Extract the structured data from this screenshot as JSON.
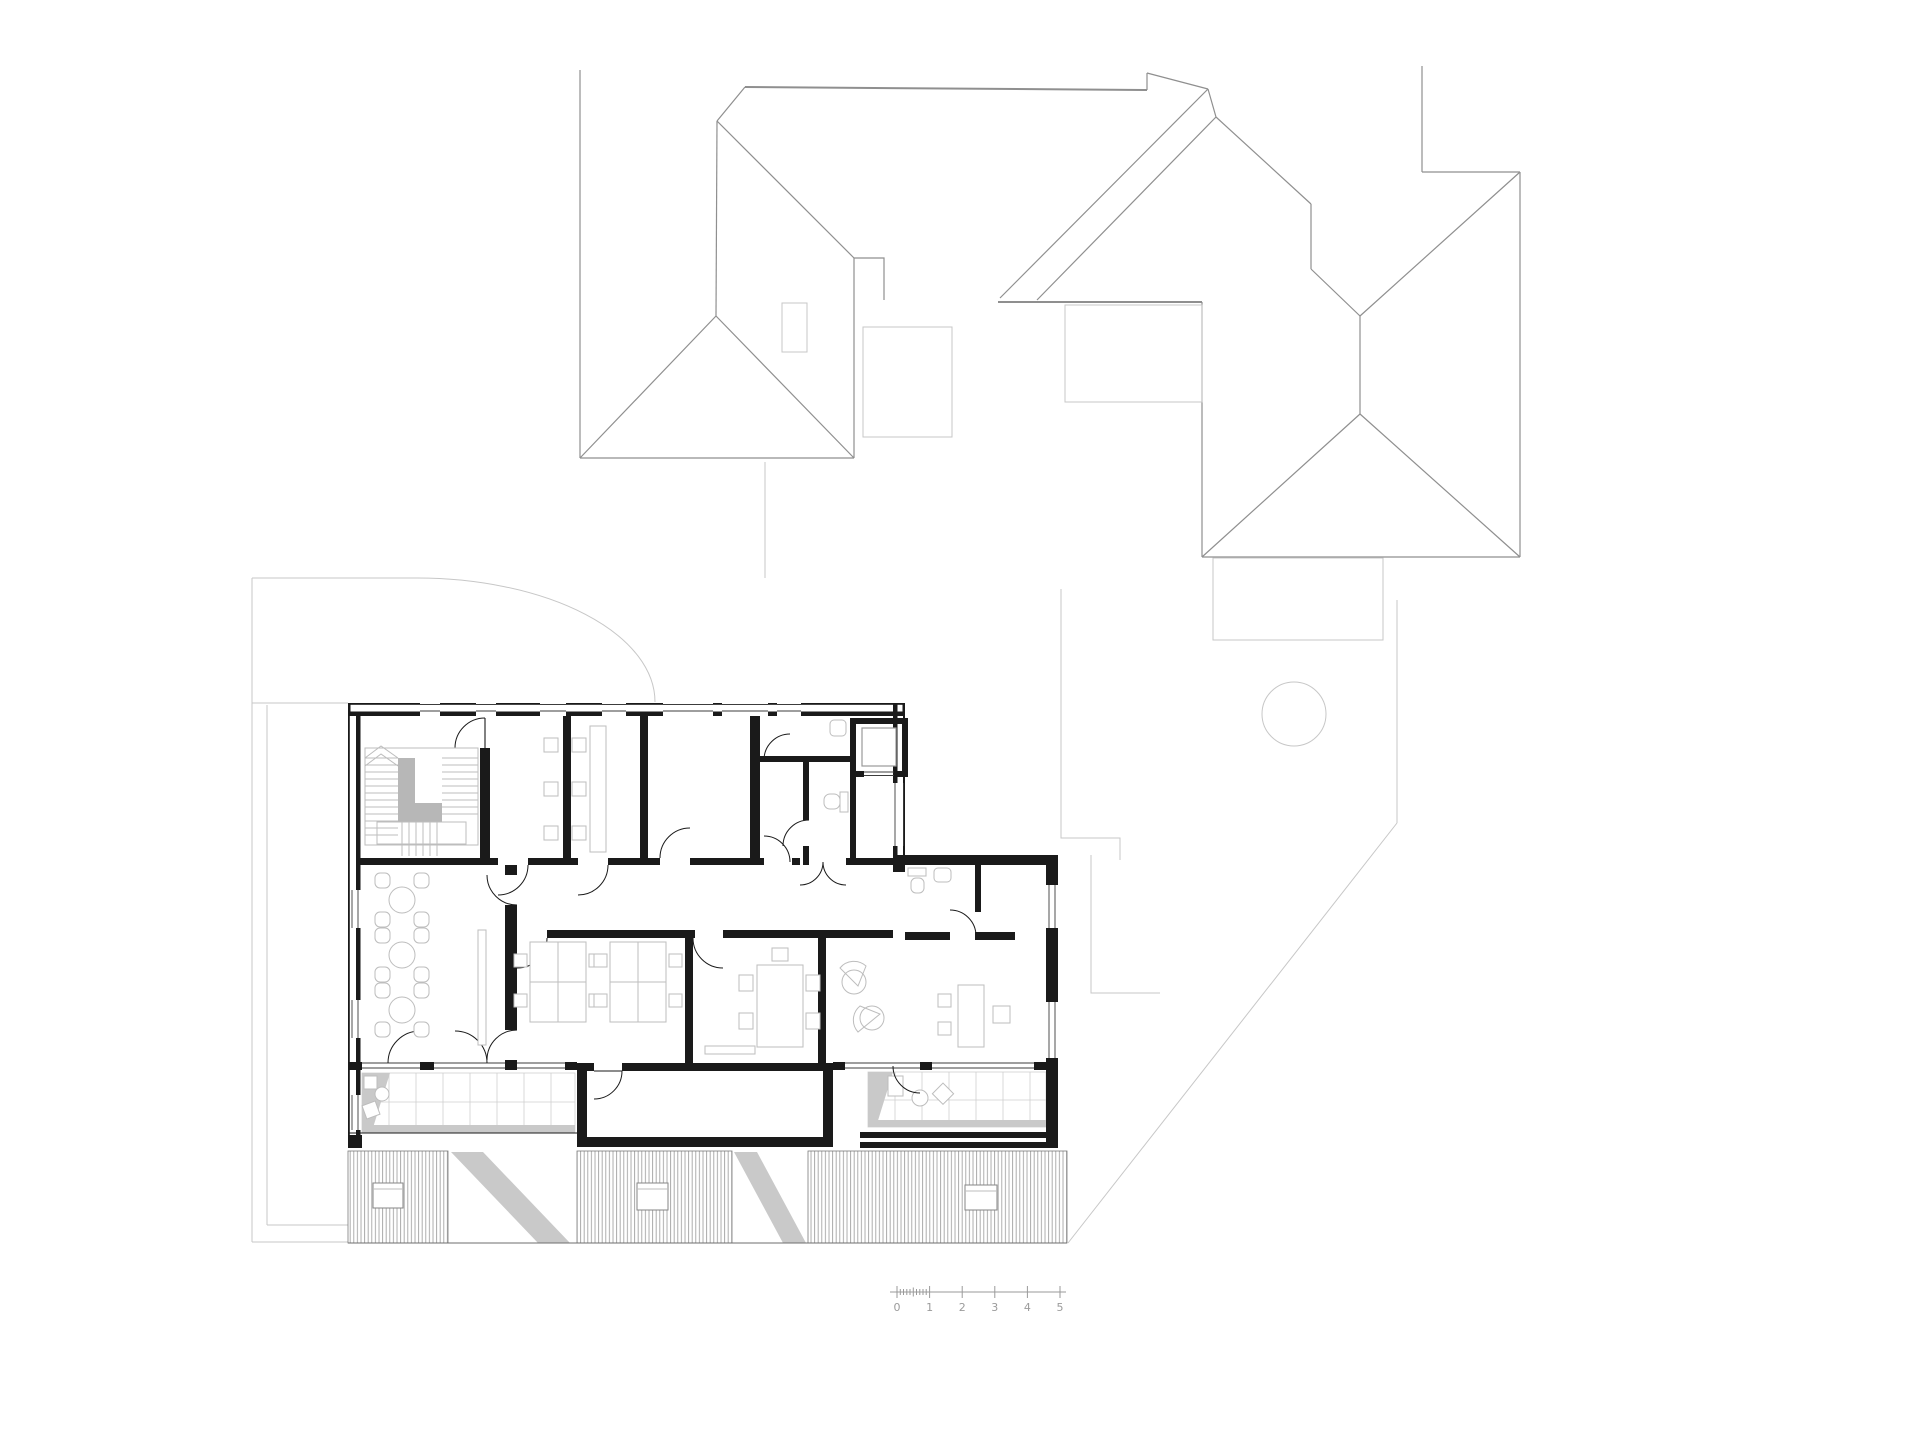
{
  "drawing": {
    "kind": "architectural floor plan with neighbouring roof plans and lower roof",
    "background": "#ffffff"
  },
  "scale_bar": {
    "unit_labels": [
      "0",
      "1",
      "2",
      "3",
      "4",
      "5"
    ]
  },
  "colors": {
    "paper": "#ffffff",
    "wall": "#1a1a1a",
    "furniture": "#bdbdbd",
    "roof": "#8f8f8f",
    "site": "#c7c7c7",
    "tile": "#cfcfcf",
    "shadow": "#c9c9c9",
    "stair_gray": "#b7b7b7",
    "hatch": "#a3a3a3",
    "scale_line": "#9a9a9a",
    "scale_text": "#9b9b9b"
  }
}
